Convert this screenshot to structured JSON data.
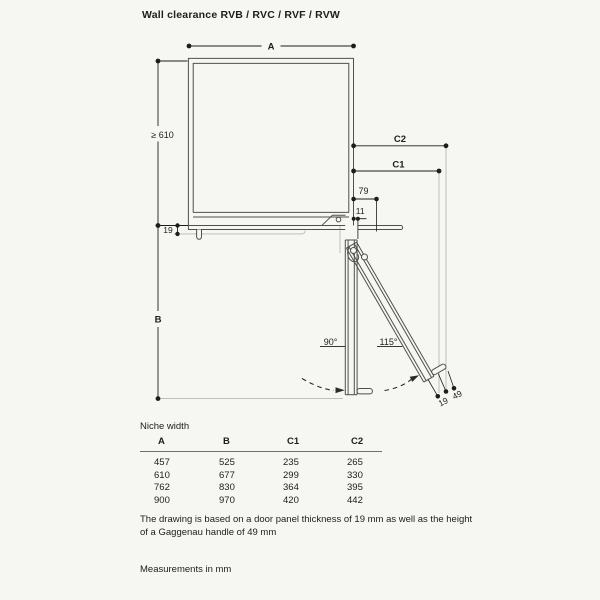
{
  "title": "Wall clearance RVB / RVC / RVF / RVW",
  "diagram": {
    "labels": {
      "dim_a": "A",
      "dim_b": "B",
      "dim_c1": "C1",
      "dim_c2": "C2",
      "min_depth": "≥ 610",
      "dim_79": "79",
      "dim_11": "11",
      "dim_19_wall": "19",
      "angle_90": "90°",
      "angle_115": "115°",
      "dim_19_door": "19",
      "dim_49_handle": "49"
    }
  },
  "table": {
    "caption": "Niche width",
    "columns": [
      "A",
      "B",
      "C1",
      "C2"
    ],
    "rows": [
      [
        "457",
        "525",
        "235",
        "265"
      ],
      [
        "610",
        "677",
        "299",
        "330"
      ],
      [
        "762",
        "830",
        "364",
        "395"
      ],
      [
        "900",
        "970",
        "420",
        "442"
      ]
    ]
  },
  "notes": {
    "drawing_basis": "The drawing is based on a door panel thickness of 19 mm as well as the height of a Gaggenau handle of 49 mm",
    "units": "Measurements in mm"
  },
  "colors": {
    "background": "#f6f6f3",
    "dimension_line": "#1d1d1b",
    "object_line": "#4f4f4b",
    "light_line": "#b7b7b3"
  }
}
